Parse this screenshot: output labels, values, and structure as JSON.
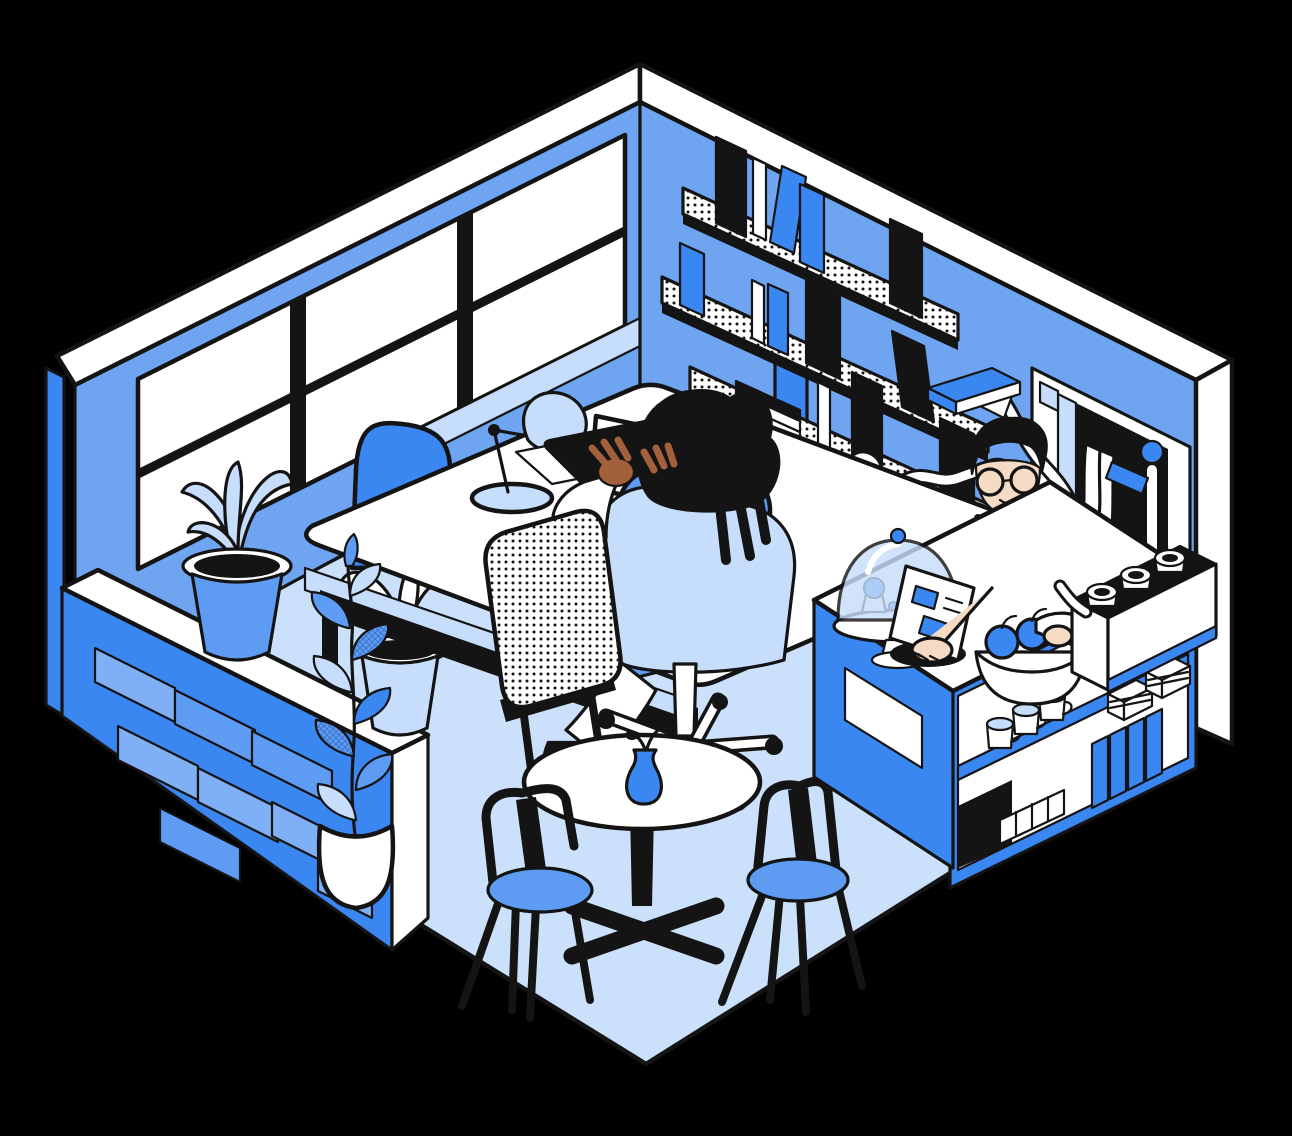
{
  "meta": {
    "alt": "Isometric line illustration of a blue café workspace: a worker typing at a desk by a big window, a barista with round glasses and a black apron behind a service counter, wall bookshelves, plants, a round café table with two chairs, and a brick half-wall.",
    "canvas": {
      "width": 1292,
      "height": 1136
    }
  },
  "palette": {
    "background": "#000000",
    "ink": "#141414",
    "white": "#ffffff",
    "floor": "#CBE0FB",
    "wall": "#6FA4F1",
    "accent": "#3B87F2",
    "brick": "#7FAFF5",
    "mid": "#5E9BF3",
    "pale": "#C6DDFB",
    "skin_dark": "#A2613C",
    "skin_light": "#F5DBC4"
  },
  "objects": {
    "window": {
      "panes": 6,
      "mullion_color": "#141414"
    },
    "sill_plants": 2,
    "brick_half_wall": {
      "bricks": 8
    },
    "bookshelf": {
      "shelves": 3,
      "standing_books": 14,
      "hanging_books": 3,
      "floating_book_held_by_pipe_arm": 1
    },
    "desk": {
      "monitor": 1,
      "laptop": 1,
      "paper_stack": 1,
      "desk_lamp": 1
    },
    "chairs": {
      "blue_side_chair": 1,
      "office_chair": 1,
      "dotted_chair": 1,
      "cafe_chairs": 2
    },
    "people": [
      {
        "role": "worker",
        "activity": "typing on laptop",
        "hair": "black locs"
      },
      {
        "role": "barista",
        "accessories": [
          "round glasses",
          "black apron",
          "white tee"
        ]
      }
    ],
    "cafe_table": {
      "vase": 1,
      "vase_color": "#3B87F2"
    },
    "pothos_plant": {
      "pot": "white",
      "leaves": 9
    },
    "counter": {
      "menu_panel": 1,
      "cake_dome": 1,
      "cupcakes": 2,
      "register": 1,
      "fruit_bowl": {
        "apples": 2,
        "bananas": 1
      },
      "espresso_machine_cups": 3,
      "shelf_mugs": 3,
      "cake_slices": 2,
      "cup_stack": 4,
      "box": 1
    },
    "service_door": {
      "towel": 1,
      "tap_valve": 1,
      "pipes": true
    }
  }
}
